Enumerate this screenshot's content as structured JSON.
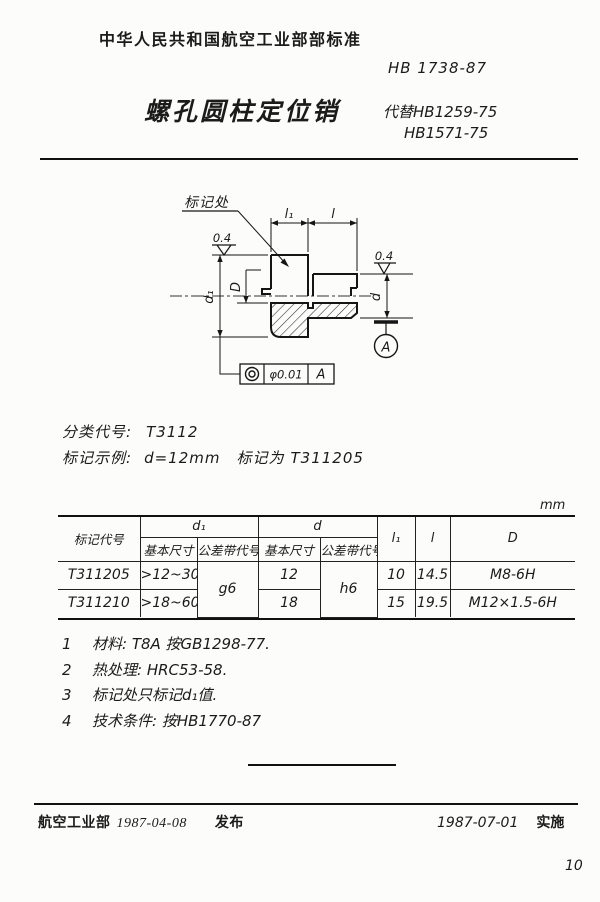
{
  "header": {
    "org": "中华人民共和国航空工业部部标准",
    "code": "HB 1738-87",
    "title": "螺孔圆柱定位销",
    "replace_line1": "代替HB1259-75",
    "replace_line2": "HB1571-75"
  },
  "drawing": {
    "marking_label": "标记处",
    "roughness": "0.4",
    "dims": {
      "l1": "l₁",
      "l": "l",
      "d1": "d₁",
      "d": "d",
      "D": "D"
    },
    "datum": "A",
    "fcf": {
      "value": "φ0.01",
      "datum": "A"
    }
  },
  "classification": {
    "label": "分类代号:",
    "value": "T3112"
  },
  "example": {
    "label": "标记示例:",
    "condition": "d=12mm",
    "middle": "标记为",
    "code": "T311205"
  },
  "table": {
    "unit": "mm",
    "head": {
      "code": "标记代号",
      "d1": "d₁",
      "d": "d",
      "basic": "基本尺寸",
      "tol": "公差带代号",
      "l1": "l₁",
      "l": "l",
      "D": "D"
    },
    "rows": [
      {
        "code": "T311205",
        "d1_basic": ">12~30",
        "d1_tol": "g6",
        "d_basic": "12",
        "d_tol": "h6",
        "l1": "10",
        "l": "14.5",
        "D": "M8-6H"
      },
      {
        "code": "T311210",
        "d1_basic": ">18~60",
        "d_basic": "18",
        "l1": "15",
        "l": "19.5",
        "D": "M12×1.5-6H"
      }
    ]
  },
  "notes": [
    {
      "num": "1",
      "text": "材料: T8A  按GB1298-77."
    },
    {
      "num": "2",
      "text": "热处理: HRC53-58."
    },
    {
      "num": "3",
      "text": "标记处只标记d₁值."
    },
    {
      "num": "4",
      "text": "技术条件: 按HB1770-87"
    }
  ],
  "footer": {
    "org": "航空工业部",
    "issue_date": "1987-04-08",
    "issue_label": "发布",
    "impl_date": "1987-07-01",
    "impl_label": "实施"
  },
  "page_number": "10"
}
